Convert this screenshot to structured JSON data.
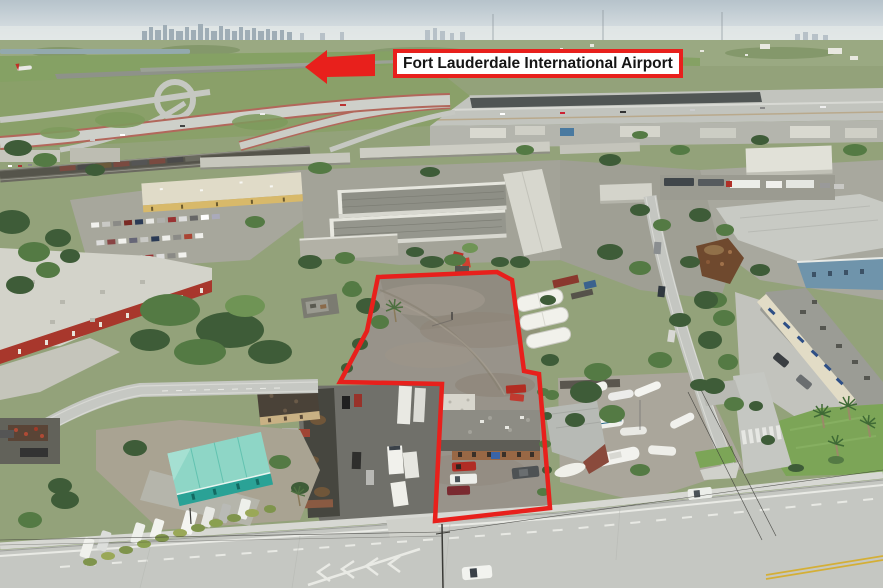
{
  "annotations": {
    "airport_label": "Fort Lauderdale International Airport",
    "annotation_color": "#e8201c",
    "arrow_points": "305,67 327,50 327,57 375,54 375,76 327,77 327,84",
    "parcel_outline_points": "378,277 497,272 512,280 524,371 539,374 550,508 435,521 442,384 340,382 367,331"
  }
}
